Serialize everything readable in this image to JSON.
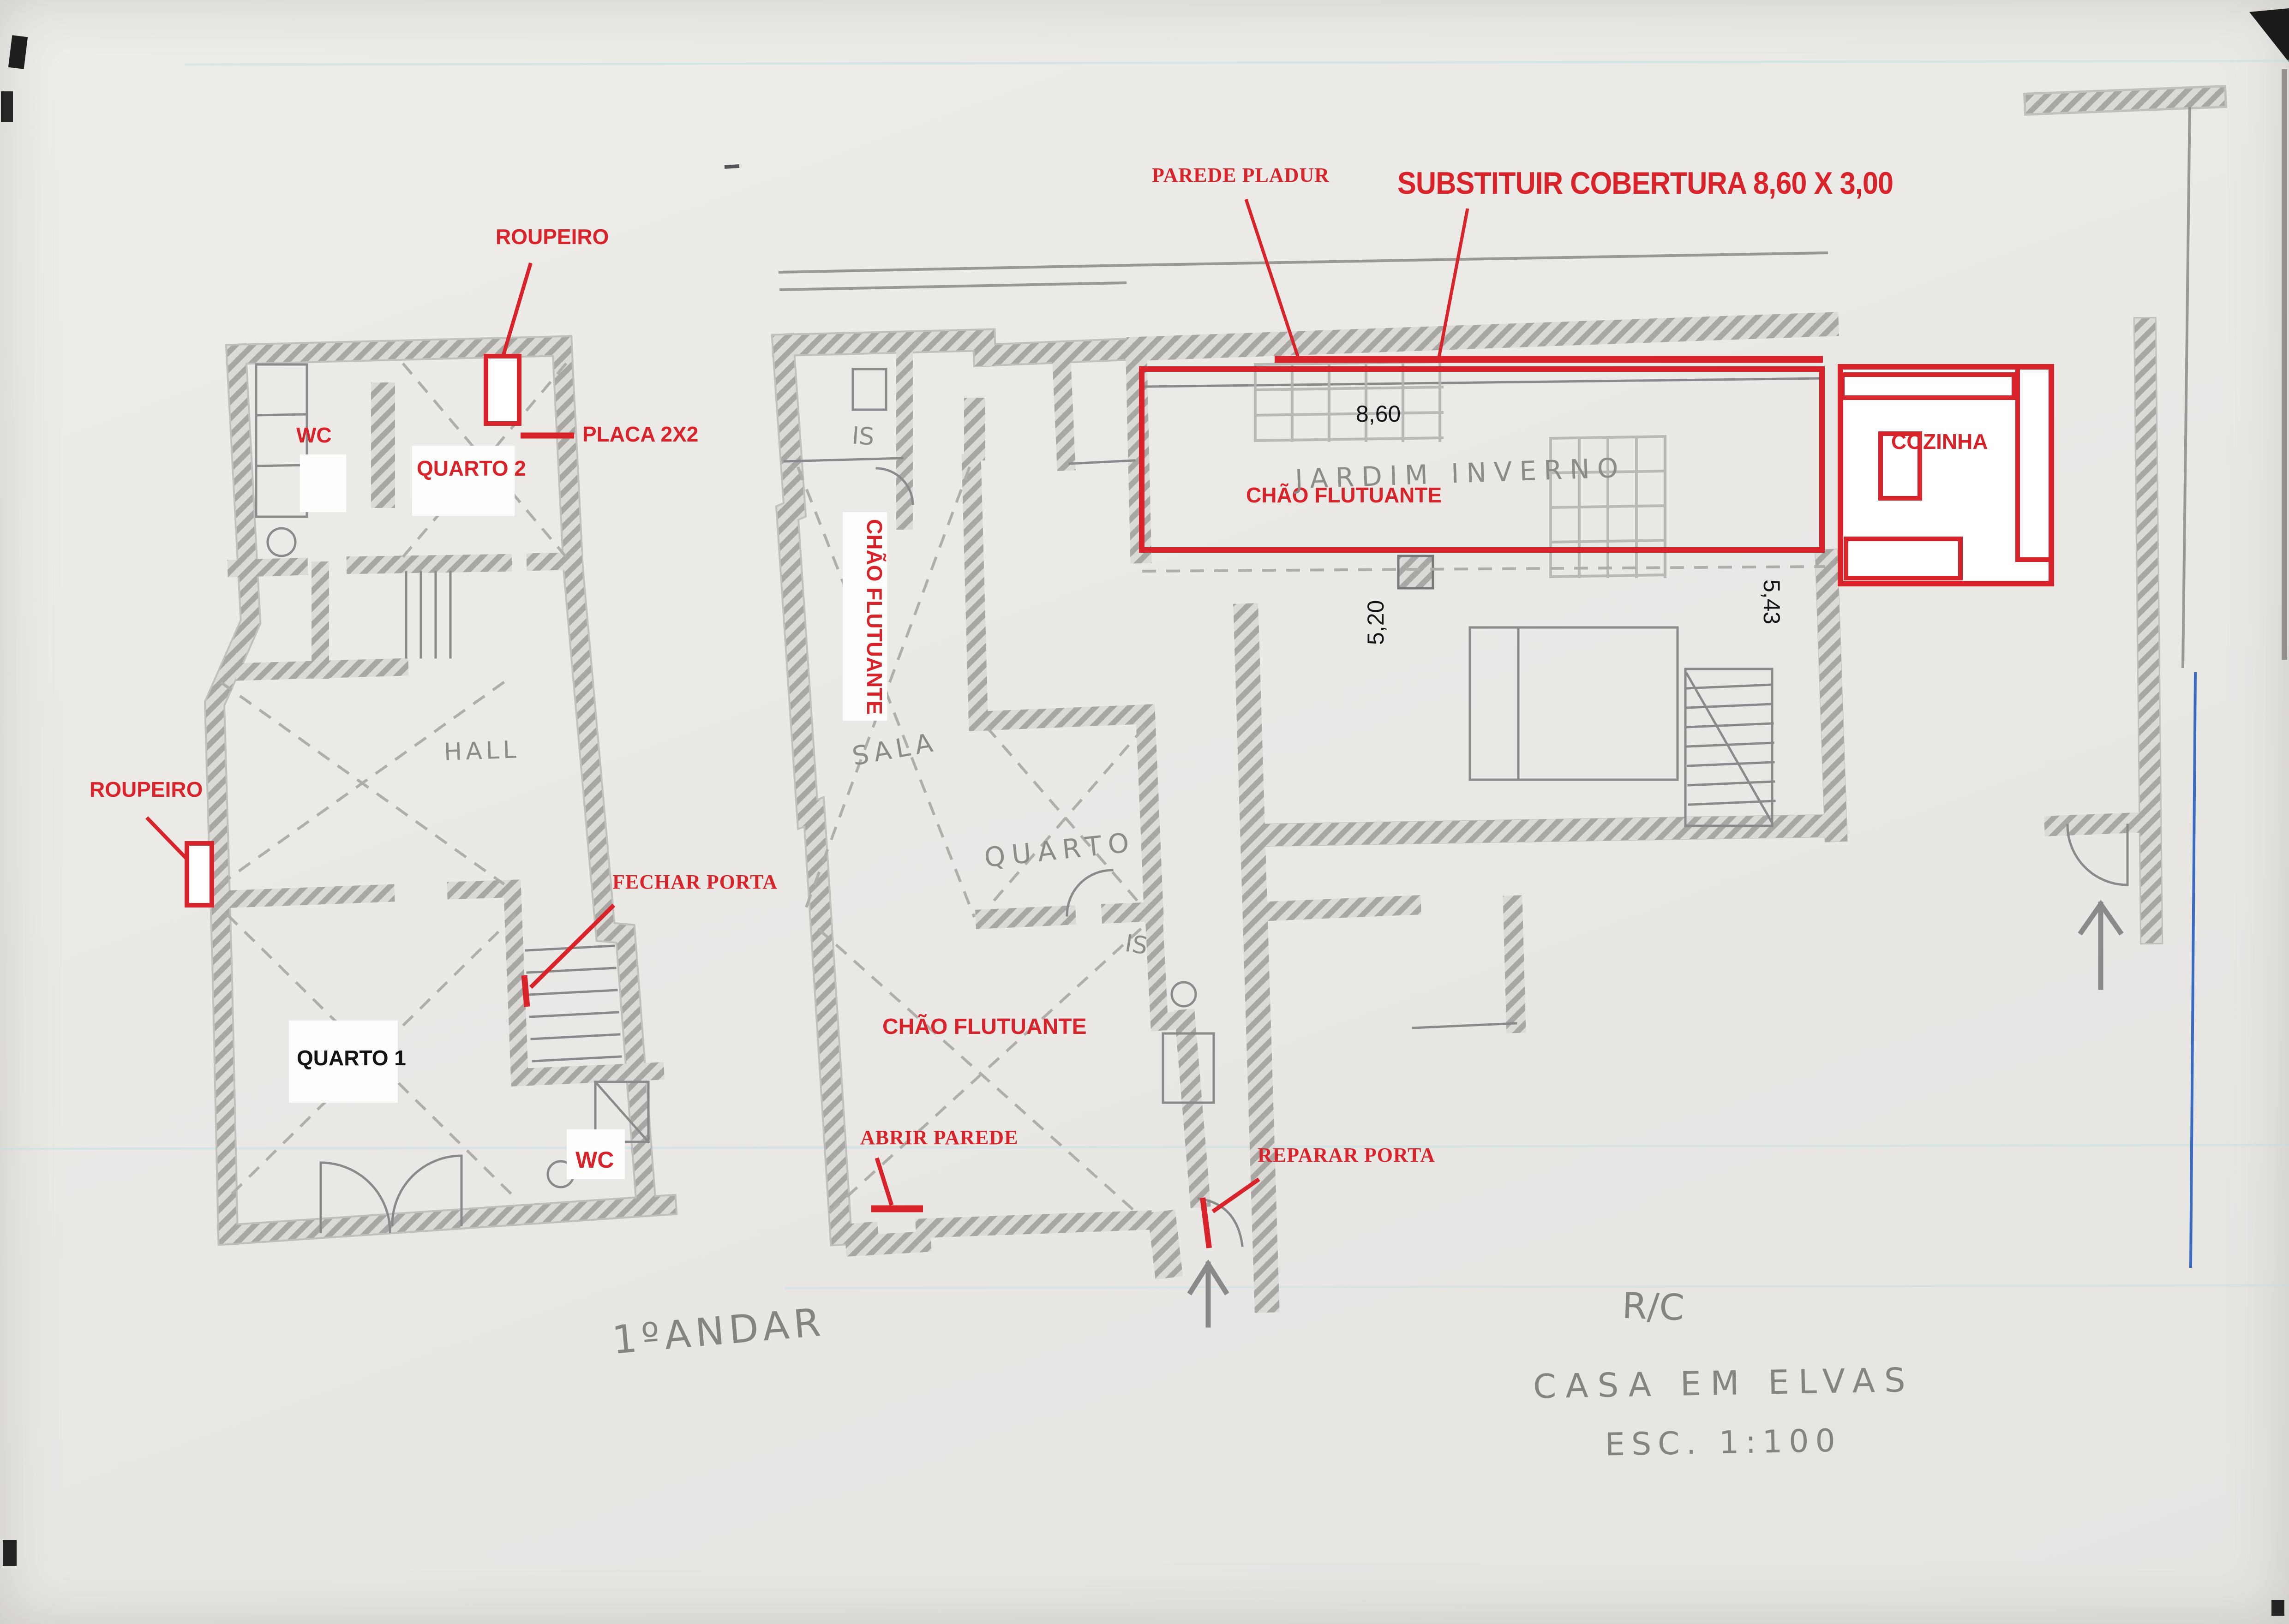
{
  "document": {
    "type": "scanned floor plan sketch",
    "project": "CASA EM ELVAS",
    "scale_note": "ESC. 1:100",
    "floors": {
      "left_plan": "1ºANDAR",
      "right_plan": "R/C"
    }
  },
  "colors": {
    "annotation_red": "#d8232a",
    "pencil_gray": "#8d8b88",
    "paper": "#ebe9e6",
    "blue_pen": "#3a6bc4"
  },
  "red_annotations": {
    "roupeiro_top": "ROUPEIRO",
    "roupeiro_left": "ROUPEIRO",
    "placa": "PLACA 2X2",
    "wc_upper": "WC",
    "quarto2": "QUARTO 2",
    "fechar_porta": "FECHAR PORTA",
    "wc_lower": "WC",
    "chao_flutuante_vertical": "CHÃO FLUTUANTE",
    "chao_flutuante_middle": "CHÃO FLUTUANTE",
    "chao_flutuante_jardim": "CHÃO FLUTUANTE",
    "abrir_parede": "ABRIR PAREDE",
    "reparar_porta": "REPARAR PORTA",
    "parede_pladur": "PAREDE PLADUR",
    "substituir_cobertura": "SUBSTITUIR COBERTURA 8,60 X 3,00",
    "cozinha": "COZINHA"
  },
  "black_annotations": {
    "quarto1": "QUARTO 1",
    "dim_width": "8,60",
    "dim_left": "5,20",
    "dim_right": "5,43"
  },
  "pencil_labels": {
    "hall": "HALL",
    "sala": "SALA",
    "quarto": "QUARTO",
    "is_upper": "IS",
    "is_lower": "IS",
    "jardim_inverno": "JARDIM INVERNO",
    "floor_left": "1ºANDAR",
    "floor_right": "R/C",
    "project": "CASA EM ELVAS",
    "scale": "ESC. 1:100"
  }
}
